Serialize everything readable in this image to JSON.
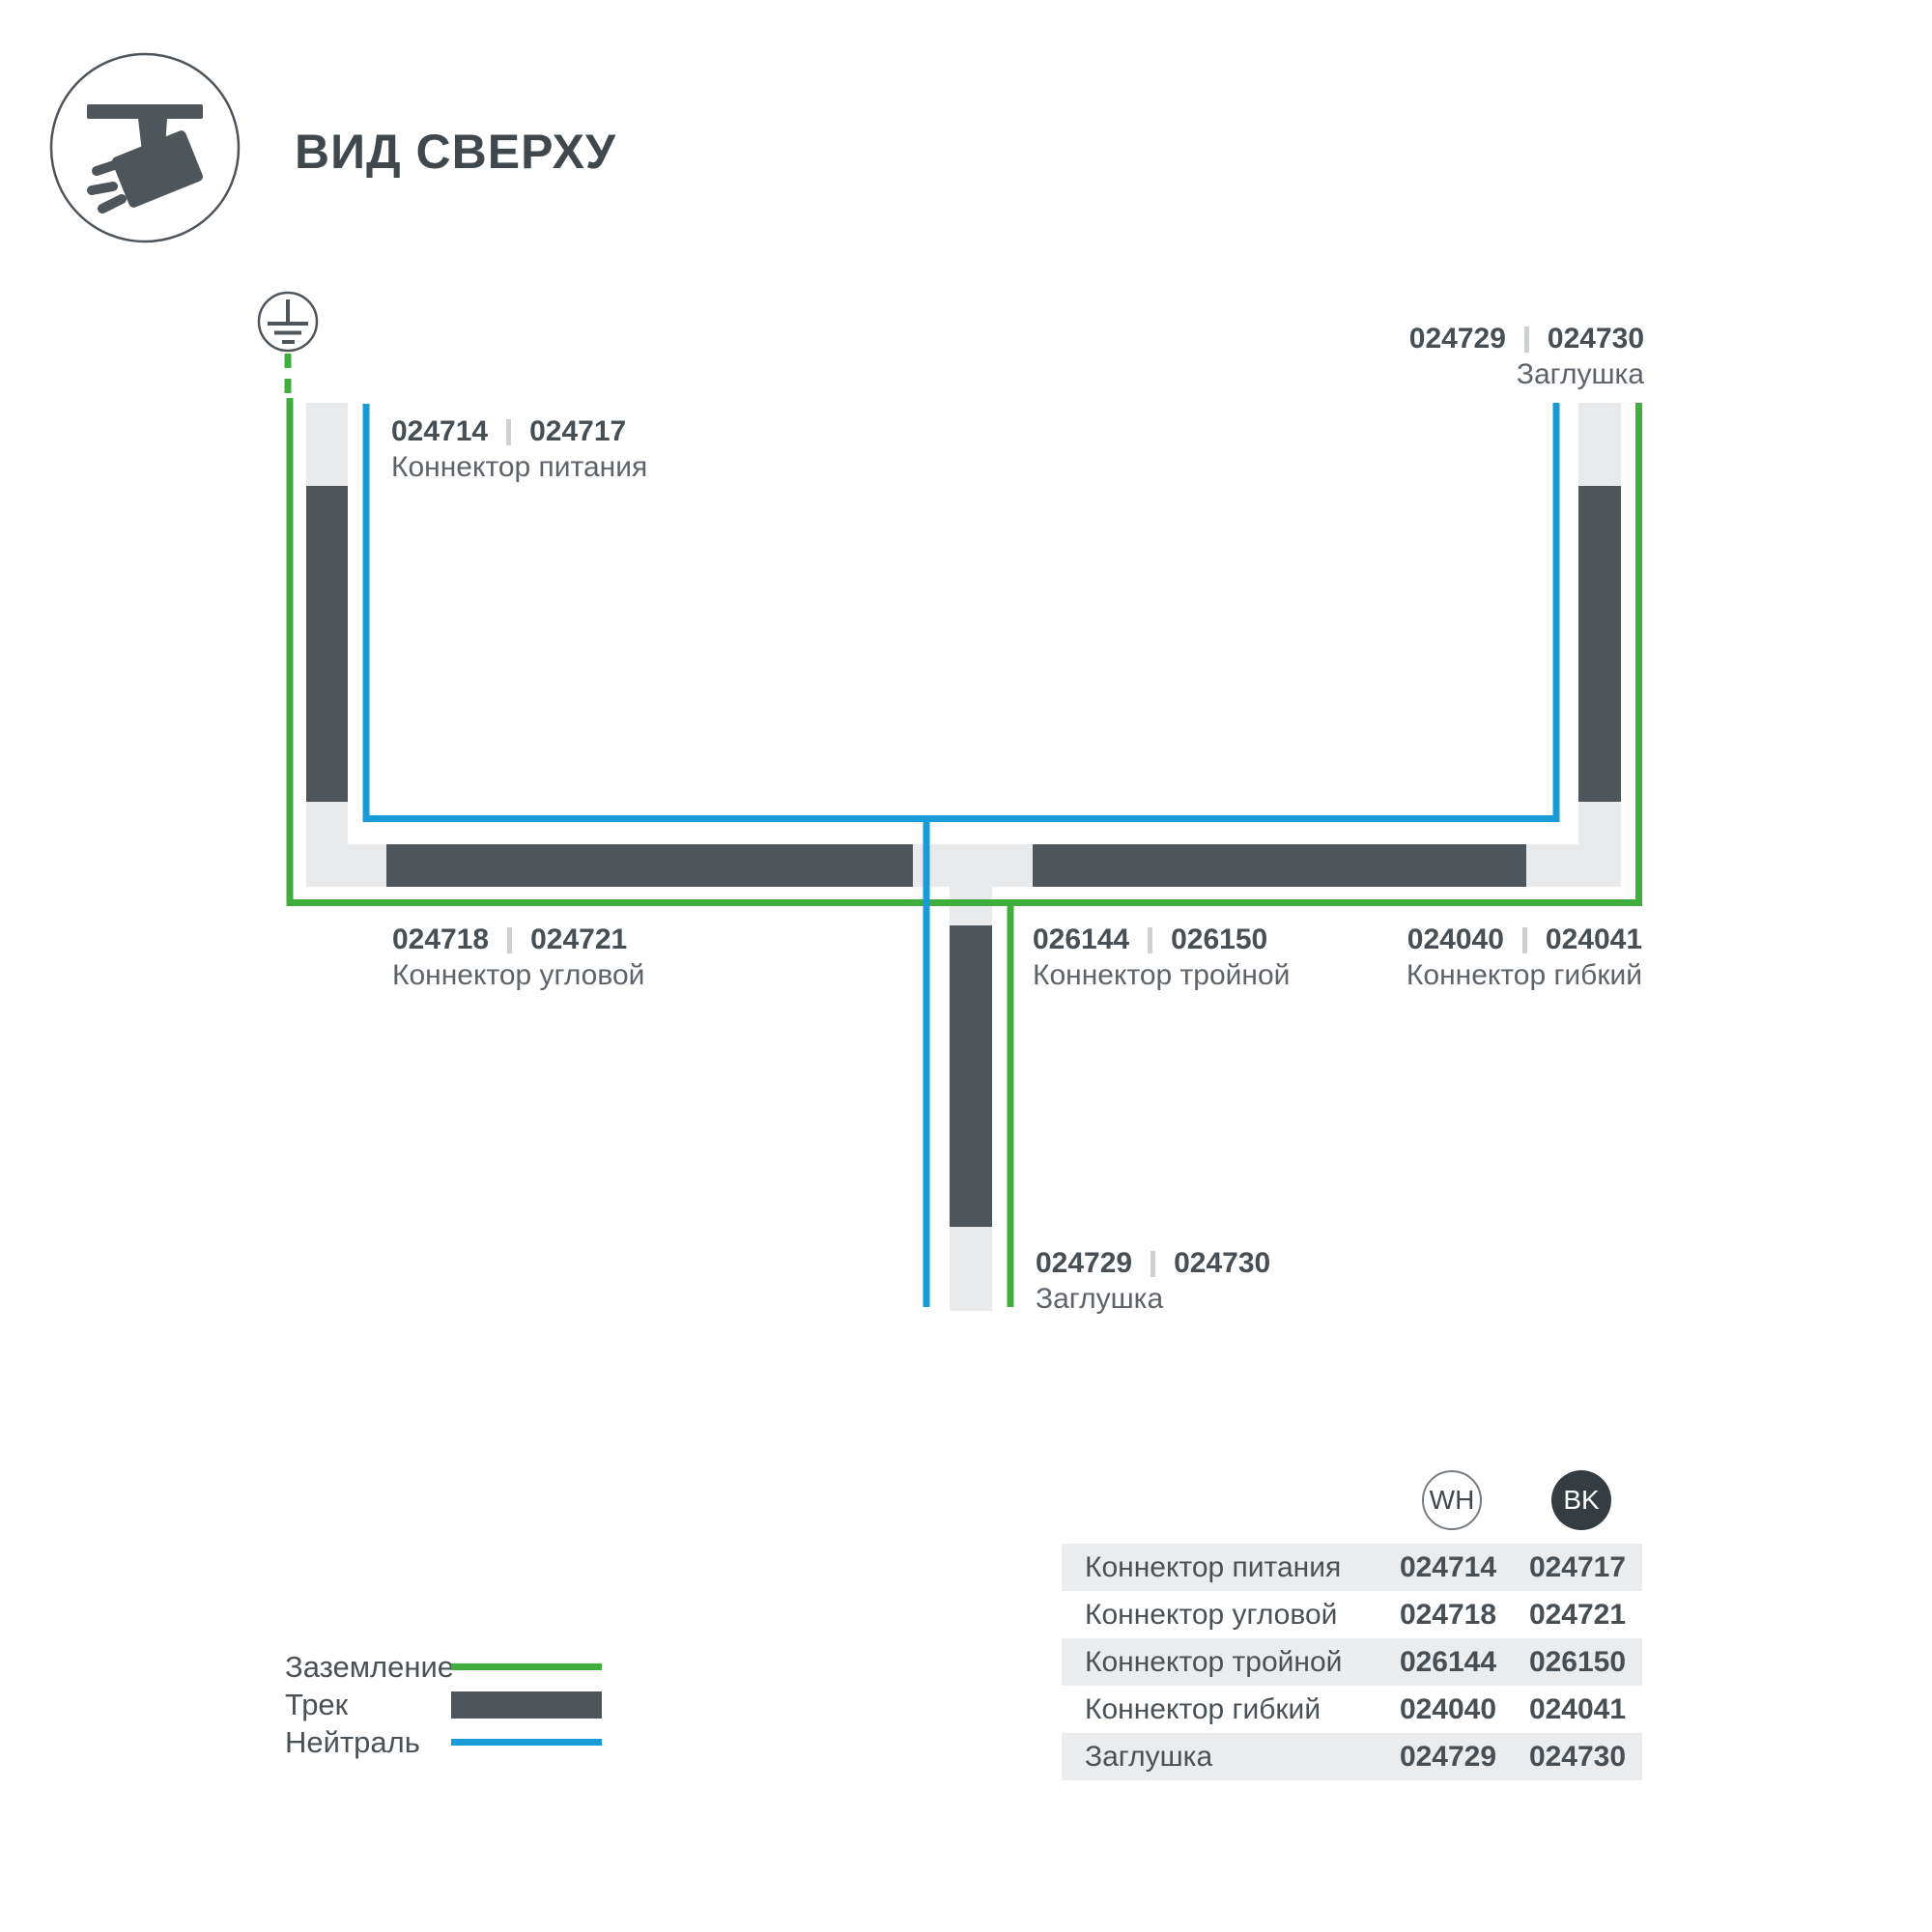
{
  "header": {
    "title": "ВИД СВЕРХУ",
    "icon": "ceiling-track-spotlight-icon"
  },
  "diagram": {
    "ground_symbol": "earth-ground-icon",
    "labels": {
      "power": {
        "wh": "024714",
        "bk": "024717",
        "name": "Коннектор питания"
      },
      "end_cap_top": {
        "wh": "024729",
        "bk": "024730",
        "name": "Заглушка"
      },
      "corner": {
        "wh": "024718",
        "bk": "024721",
        "name": "Коннектор угловой"
      },
      "triple": {
        "wh": "026144",
        "bk": "026150",
        "name": "Коннектор тройной"
      },
      "flexible": {
        "wh": "024040",
        "bk": "024041",
        "name": "Коннектор гибкий"
      },
      "end_cap_bottom": {
        "wh": "024729",
        "bk": "024730",
        "name": "Заглушка"
      }
    },
    "colors": {
      "ground_line": "#3fae3c",
      "neutral_line": "#199bd7",
      "track_dark": "#4e555b",
      "track_light": "#e9eaeb"
    }
  },
  "legend": {
    "items": [
      {
        "label": "Заземление",
        "swatch": "green-line"
      },
      {
        "label": "Трек",
        "swatch": "dark-bar"
      },
      {
        "label": "Нейтраль",
        "swatch": "blue-line"
      }
    ]
  },
  "table": {
    "columns": [
      {
        "label": "WH"
      },
      {
        "label": "BK"
      }
    ],
    "rows": [
      {
        "name": "Коннектор питания",
        "wh": "024714",
        "bk": "024717"
      },
      {
        "name": "Коннектор угловой",
        "wh": "024718",
        "bk": "024721"
      },
      {
        "name": "Коннектор тройной",
        "wh": "026144",
        "bk": "026150"
      },
      {
        "name": "Коннектор гибкий",
        "wh": "024040",
        "bk": "024041"
      },
      {
        "name": "Заглушка",
        "wh": "024729",
        "bk": "024730"
      }
    ]
  }
}
